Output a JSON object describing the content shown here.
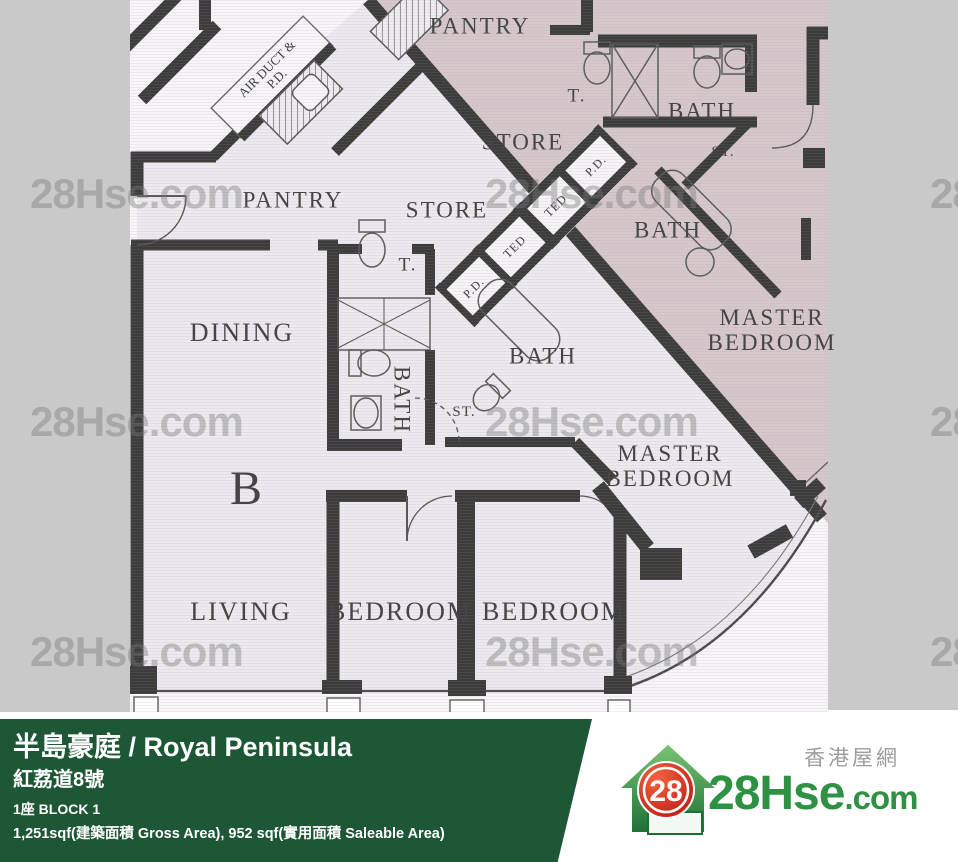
{
  "plan": {
    "labels": [
      {
        "text": "PANTRY",
        "x": 480,
        "y": 27,
        "cls": "lg"
      },
      {
        "text": "T.",
        "x": 577,
        "y": 97,
        "cls": "md"
      },
      {
        "text": "BATH",
        "x": 702,
        "y": 112,
        "cls": "lg"
      },
      {
        "text": "ST.",
        "x": 723,
        "y": 152,
        "cls": "xs"
      },
      {
        "text": "STORE",
        "x": 523,
        "y": 143,
        "cls": "lg"
      },
      {
        "text": "BATH",
        "x": 668,
        "y": 231,
        "cls": "lg"
      },
      {
        "text": "MASTER BEDROOM",
        "x": 772,
        "y": 331,
        "cls": "lg wrap",
        "w": 160
      },
      {
        "text": "AIR DUCT & P.D.",
        "x": 272,
        "y": 74,
        "cls": "duct2 wrap",
        "w": 92,
        "rot": -45
      },
      {
        "text": "PANTRY",
        "x": 293,
        "y": 201,
        "cls": "lg"
      },
      {
        "text": "STORE",
        "x": 447,
        "y": 211,
        "cls": "lg"
      },
      {
        "text": "T.",
        "x": 408,
        "y": 266,
        "cls": "md"
      },
      {
        "text": "DINING",
        "x": 242,
        "y": 333,
        "cls": "xl"
      },
      {
        "text": "BATH",
        "x": 401,
        "y": 400,
        "cls": "lg",
        "rot": 90
      },
      {
        "text": "ST.",
        "x": 464,
        "y": 412,
        "cls": "xs"
      },
      {
        "text": "BATH",
        "x": 543,
        "y": 357,
        "cls": "lg"
      },
      {
        "text": "B",
        "x": 246,
        "y": 489,
        "cls": "bigb"
      },
      {
        "text": "LIVING",
        "x": 241,
        "y": 612,
        "cls": "xl"
      },
      {
        "text": "BEDROOM",
        "x": 400,
        "y": 612,
        "cls": "xl"
      },
      {
        "text": "BEDROOM",
        "x": 554,
        "y": 612,
        "cls": "xl"
      },
      {
        "text": "MASTER BEDROOM",
        "x": 670,
        "y": 467,
        "cls": "lg wrap",
        "w": 160
      },
      {
        "text": "P.D.",
        "x": 596,
        "y": 166,
        "cls": "duct",
        "rot": -45
      },
      {
        "text": "TED",
        "x": 556,
        "y": 206,
        "cls": "duct",
        "rot": -45
      },
      {
        "text": "TED",
        "x": 515,
        "y": 247,
        "cls": "duct",
        "rot": -45
      },
      {
        "text": "P.D.",
        "x": 474,
        "y": 288,
        "cls": "duct",
        "rot": -45
      }
    ],
    "watermark": {
      "text": "28Hse.com",
      "positions": [
        [
          30,
          170
        ],
        [
          485,
          170
        ],
        [
          930,
          170
        ],
        [
          30,
          398
        ],
        [
          485,
          398
        ],
        [
          930,
          398
        ],
        [
          30,
          628
        ],
        [
          485,
          628
        ],
        [
          930,
          628
        ]
      ]
    }
  },
  "footer": {
    "project_title": "半島豪庭 / Royal Peninsula",
    "address": "紅荔道8號",
    "block": "1座   BLOCK 1",
    "area": "1,251sqf(建築面積 Gross Area), 952 sqf(實用面積 Saleable Area)"
  },
  "logo": {
    "badge": "28",
    "brand_main": "28Hse",
    "brand_suffix": ".com",
    "site_cn": "香港屋網"
  },
  "colors": {
    "green_bar": "#1d5736",
    "logo_green": "#2e9143",
    "badge_red": "#d42422",
    "unit_a_pink": "#d6c8ca",
    "unit_b_floor": "#ece9ef",
    "wall": "#3c3c3a",
    "gray_band": "#c9c9c9"
  }
}
